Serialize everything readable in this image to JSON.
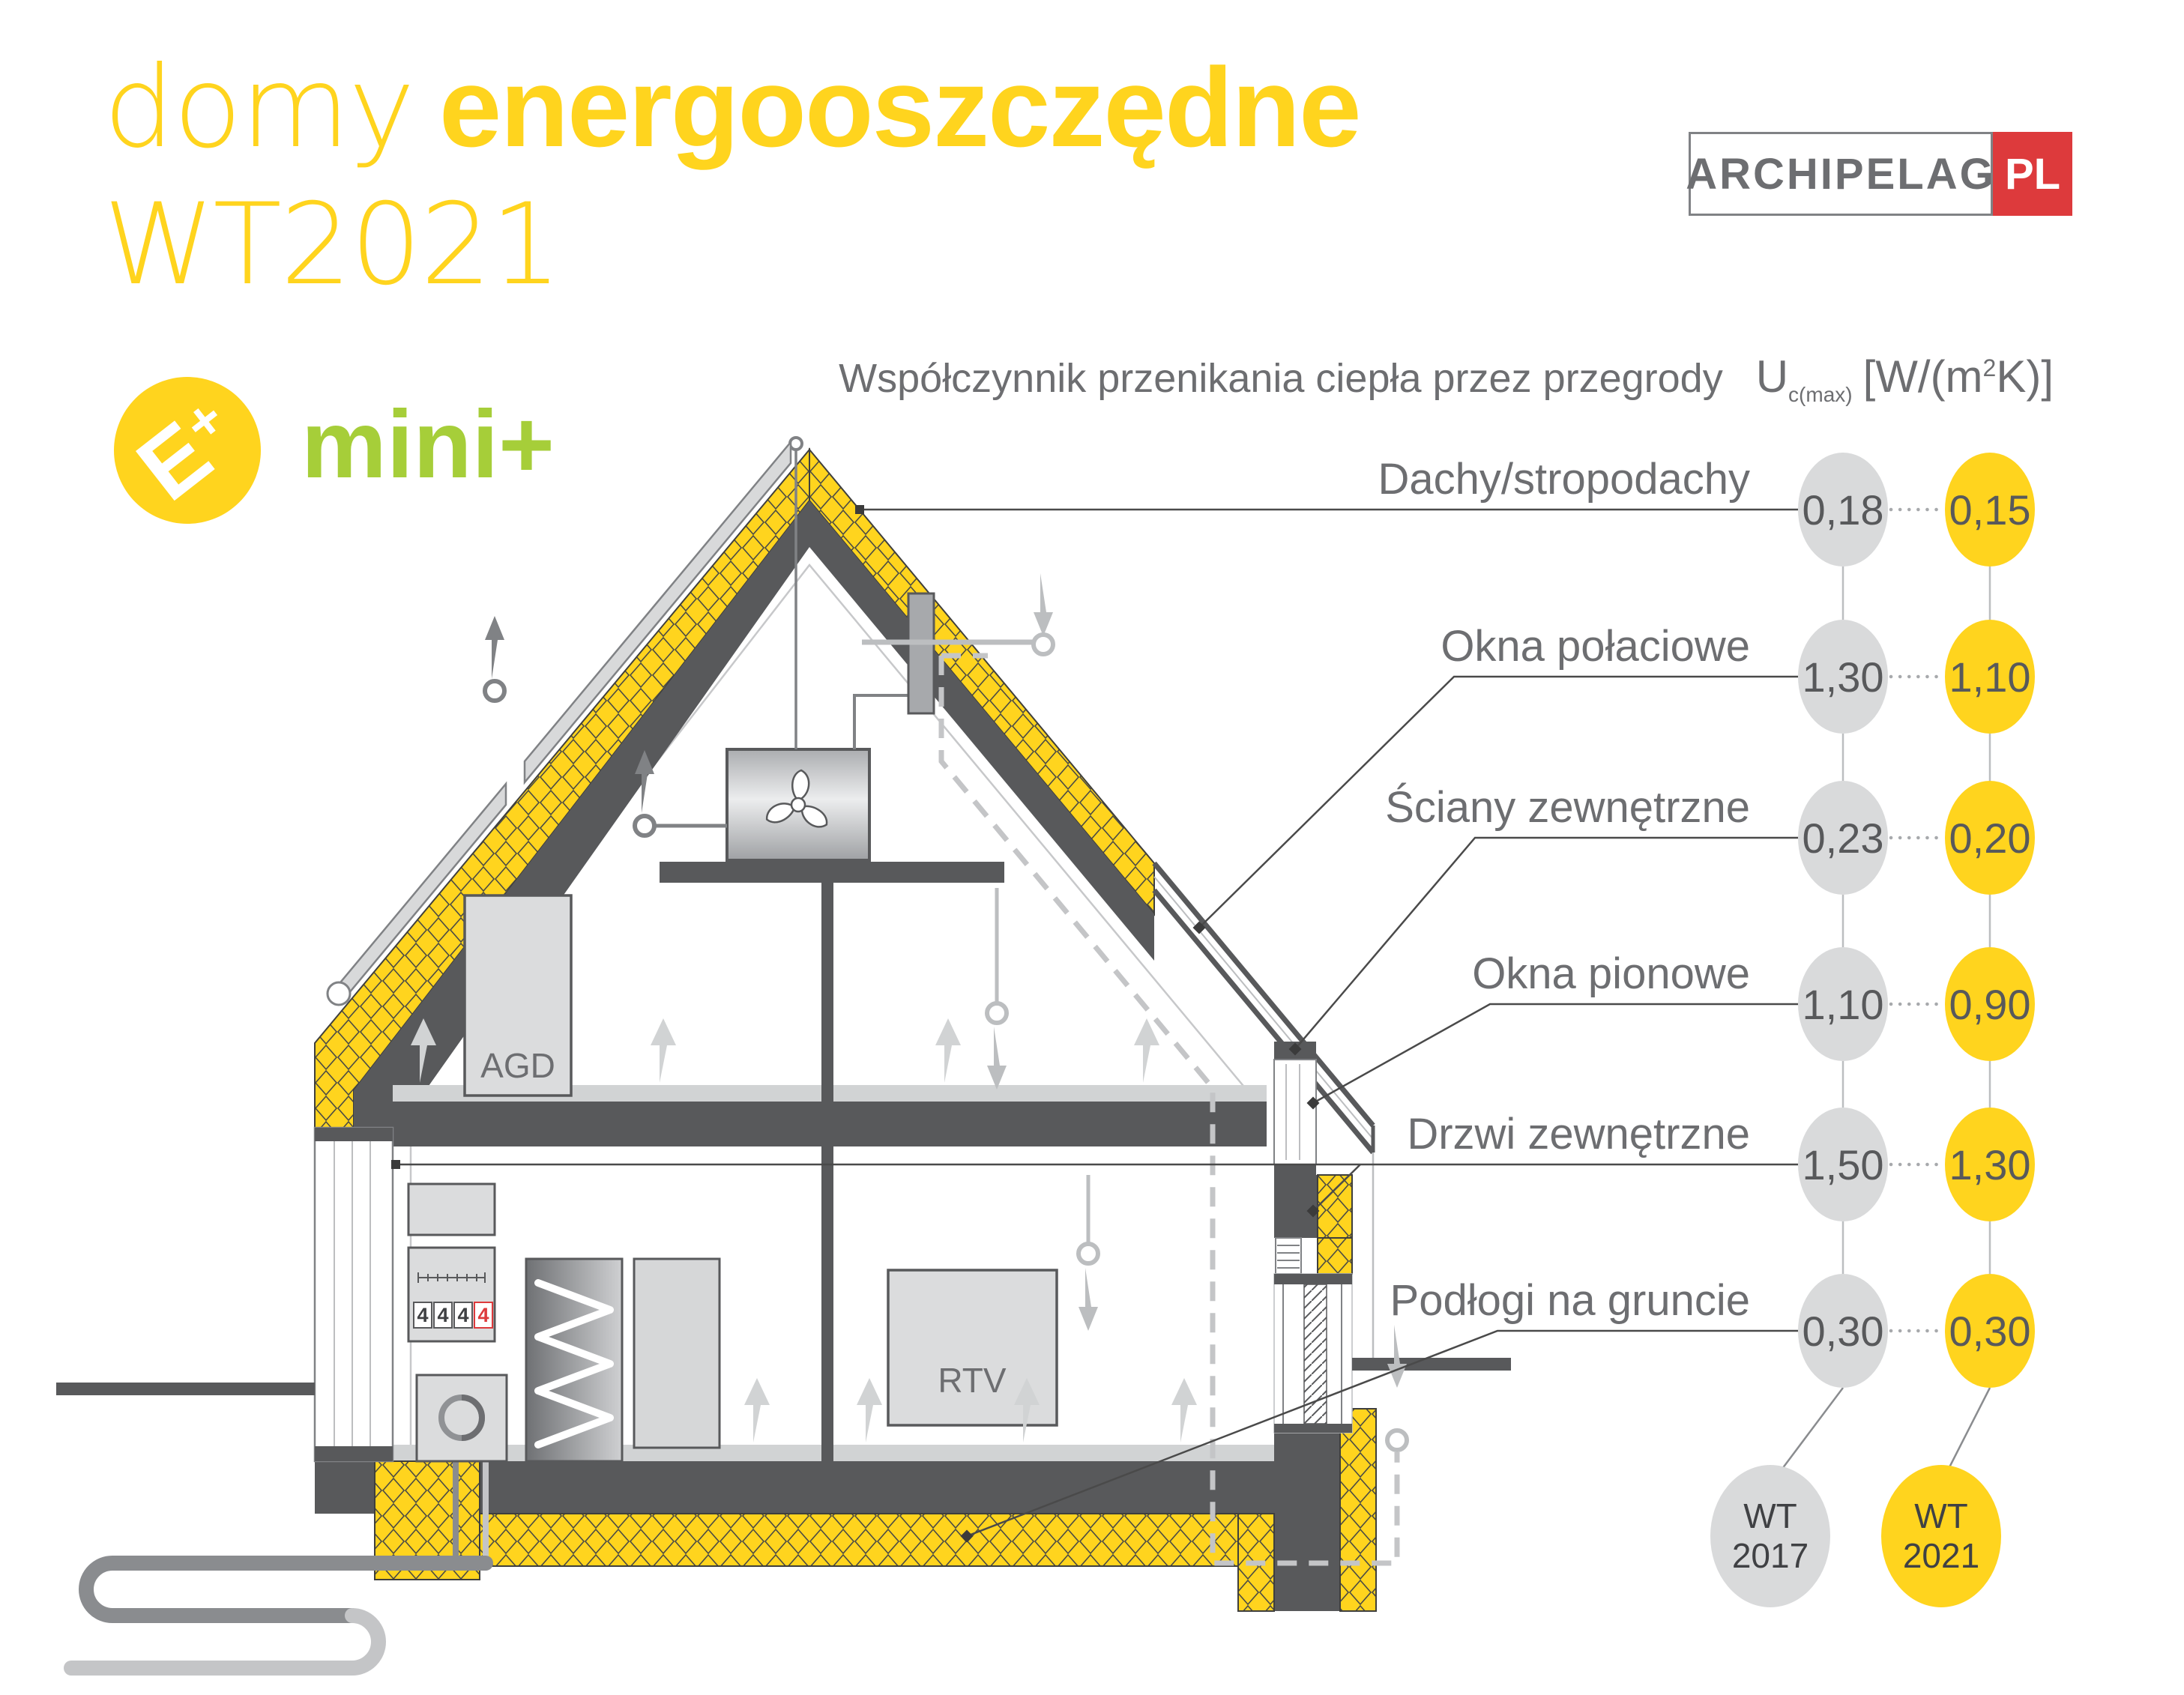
{
  "colors": {
    "accent_yellow": "#FFD41E",
    "accent_green": "#A6CE39",
    "brand_red": "#DD3A3C",
    "structure_dark": "#58595B",
    "text_gray": "#6D6E71",
    "light_gray": "#BCBEC0",
    "circle_gray": "#D9DADB"
  },
  "title": {
    "word_light": "domy",
    "word_bold": "energooszczędne",
    "line2": "WT2021"
  },
  "badges": {
    "eplus_letter": "E",
    "eplus_plus": "+",
    "mini_label": "mini+"
  },
  "brand": {
    "name": "ARCHIPELAG",
    "tld": "PL"
  },
  "uvalue_header": {
    "text": "Współczynnik przenikania ciepła przez przegrody",
    "symbol": "U",
    "symbol_sub": "c(max)",
    "unit_open": "[W/(m",
    "unit_exp": "2",
    "unit_close": "K)]"
  },
  "legend": {
    "old": {
      "line1": "WT",
      "line2": "2017"
    },
    "new": {
      "line1": "WT",
      "line2": "2021"
    }
  },
  "rows": [
    {
      "label": "Dachy/stropodachy",
      "old": "0,18",
      "new": "0,15"
    },
    {
      "label": "Okna połaciowe",
      "old": "1,30",
      "new": "1,10"
    },
    {
      "label": "Ściany zewnętrzne",
      "old": "0,23",
      "new": "0,20"
    },
    {
      "label": "Okna pionowe",
      "old": "1,10",
      "new": "0,90"
    },
    {
      "label": "Drzwi zewnętrzne",
      "old": "1,50",
      "new": "1,30"
    },
    {
      "label": "Podłogi na gruncie",
      "old": "0,30",
      "new": "0,30"
    }
  ],
  "house": {
    "agd_label": "AGD",
    "rtv_label": "RTV",
    "meter_digits": [
      "4",
      "4",
      "4",
      "4"
    ]
  }
}
